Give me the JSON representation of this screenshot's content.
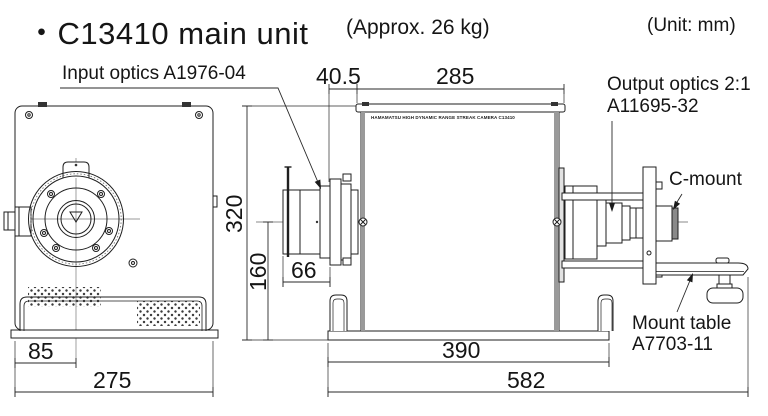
{
  "title": {
    "bullet": "・",
    "text": "C13410 main unit",
    "weight_note": "(Approx. 26 kg)"
  },
  "unit_note": "(Unit: mm)",
  "labels": {
    "input_optics": "Input optics A1976-04",
    "output_optics_line1": "Output optics 2:1",
    "output_optics_line2": "A11695-32",
    "c_mount": "C-mount",
    "mount_table_line1": "Mount table",
    "mount_table_line2": "A7703-11",
    "nameplate": "HAMAMATSU  HIGH DYNAMIC RANGE STREAK CAMERA  C13410"
  },
  "dimensions": {
    "flange_to_body": "40.5",
    "body_length": "285",
    "body_height": "320",
    "optical_axis_height": "160",
    "input_optics_length": "66",
    "front_axis_offset": "85",
    "front_width": "275",
    "base_length": "390",
    "total_length": "582"
  },
  "colors": {
    "line": "#1a1a1a",
    "wall_gray": "#9a9a9a",
    "background": "#ffffff"
  }
}
